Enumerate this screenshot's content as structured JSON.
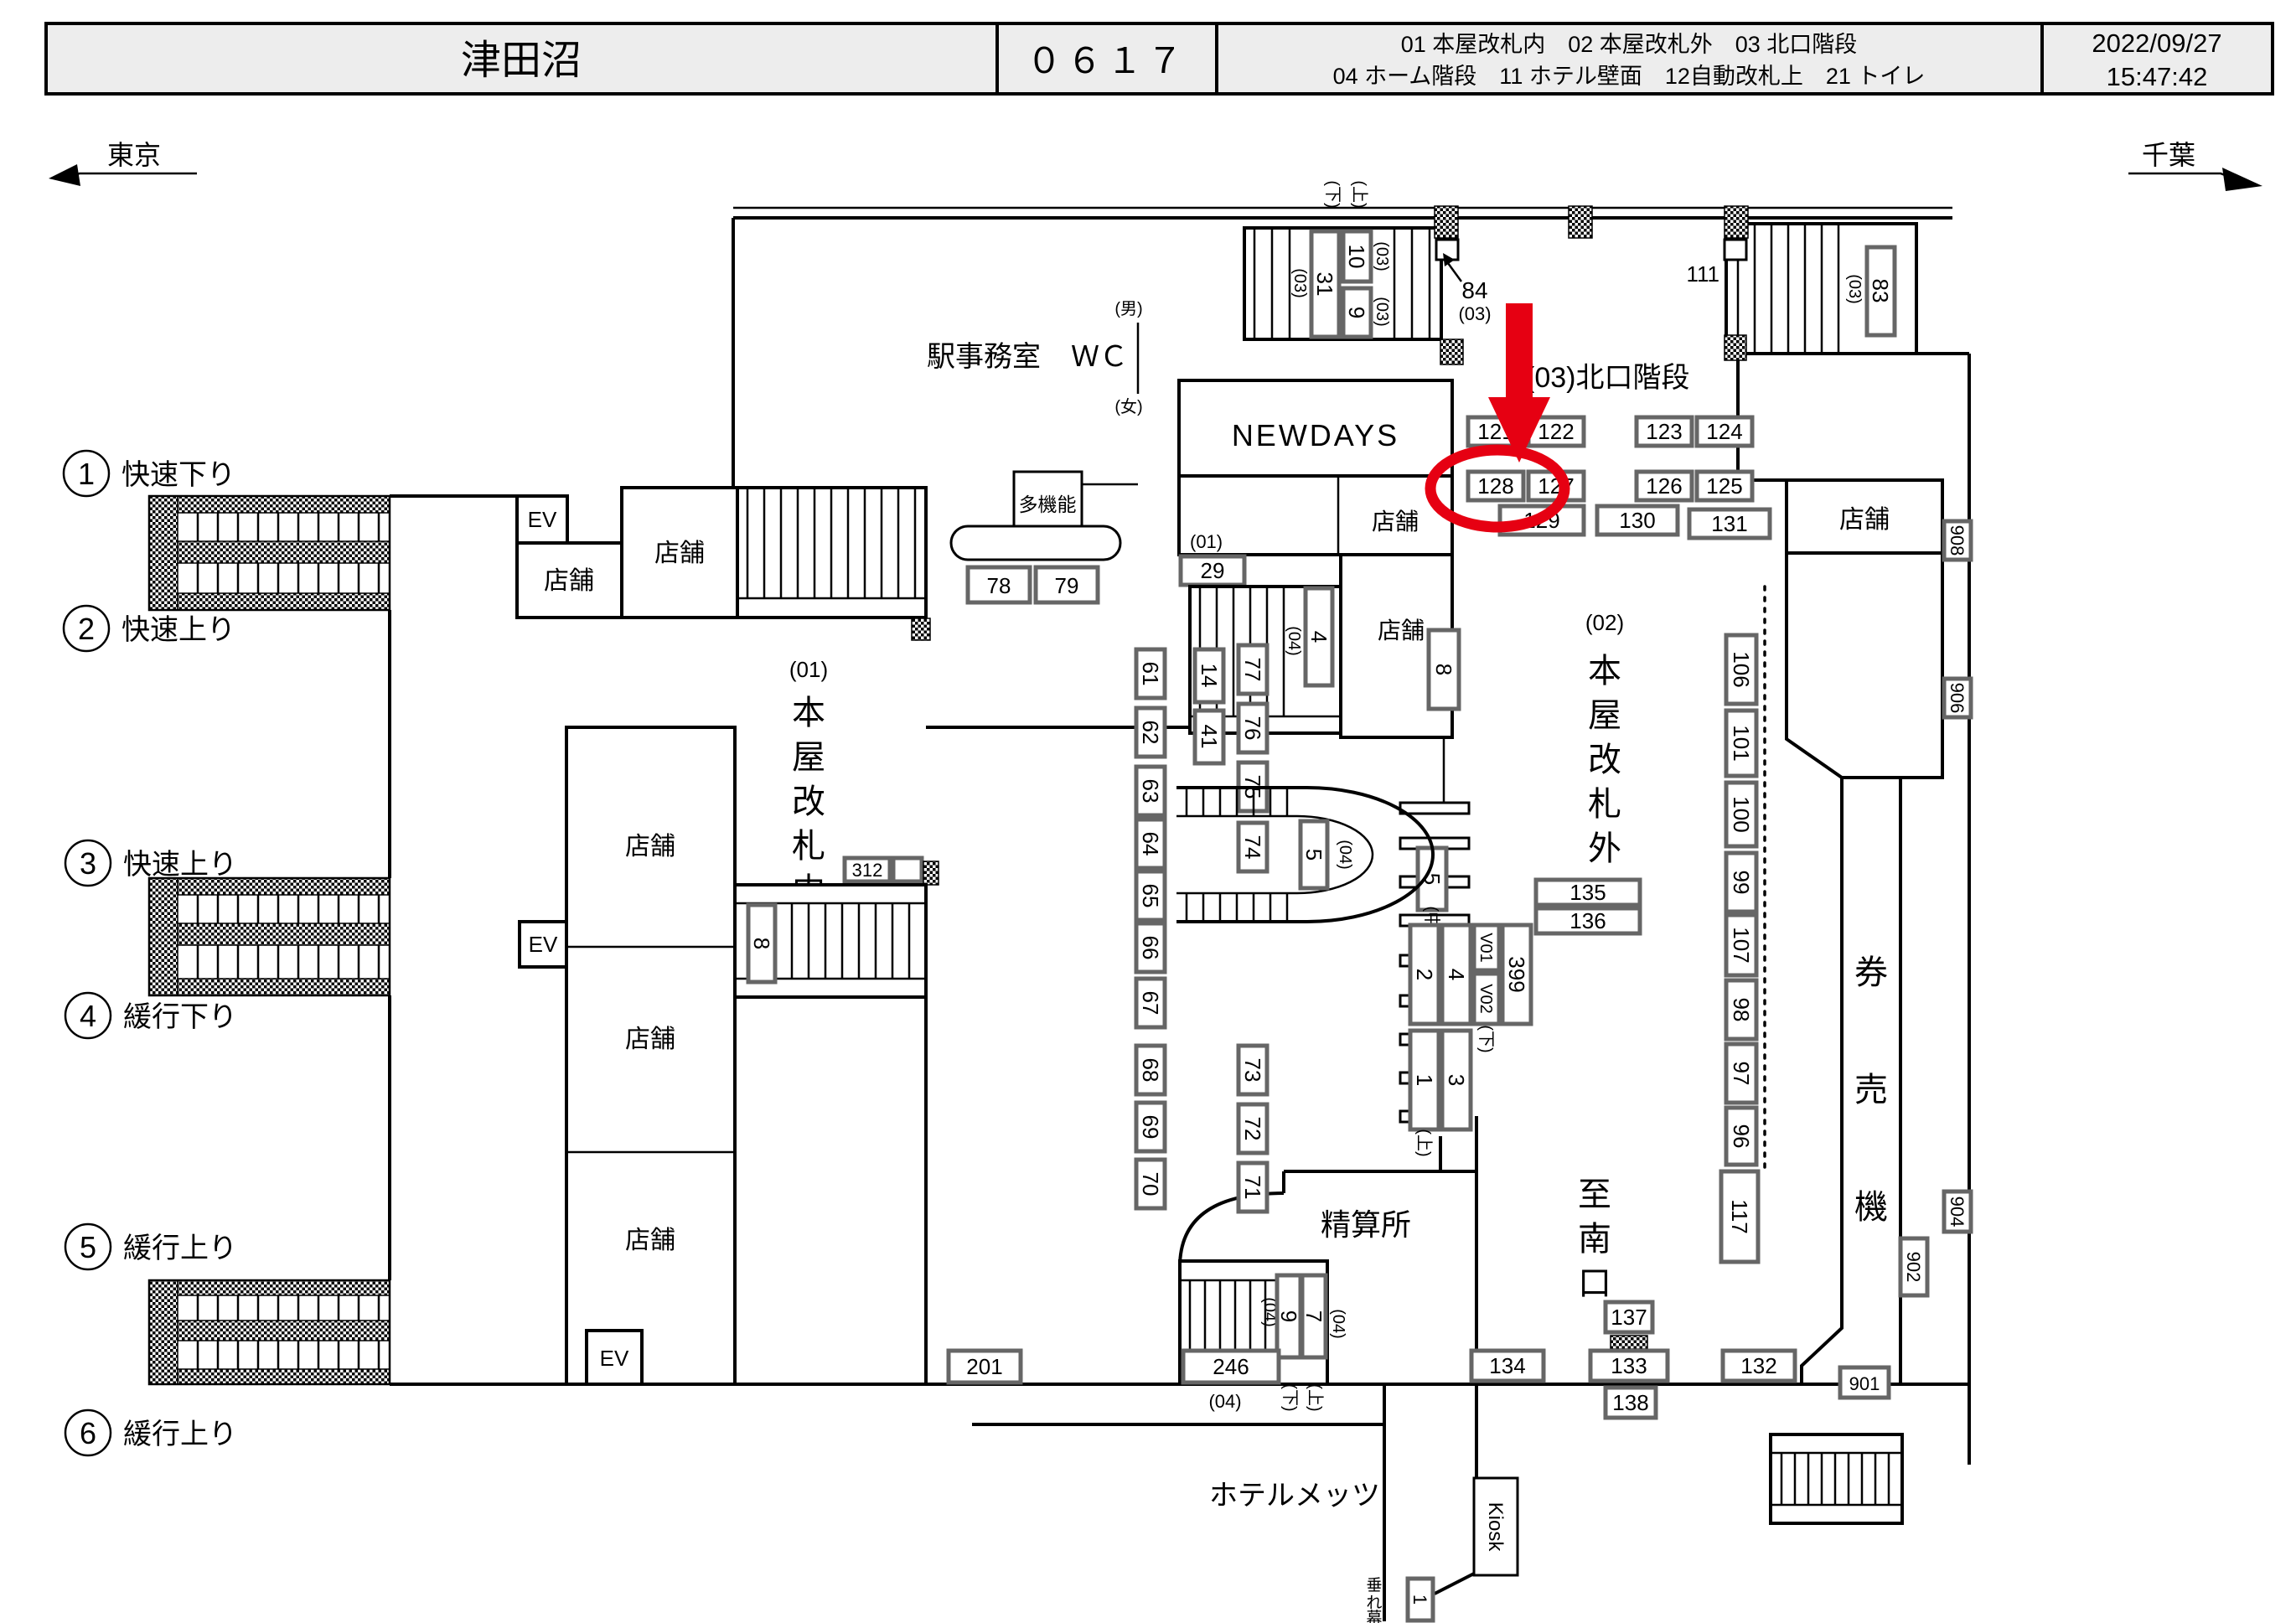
{
  "header": {
    "station": "津田沼",
    "code": "０６１７",
    "legend1": "01 本屋改札内　02 本屋改札外　03 北口階段",
    "legend2": "04 ホーム階段　11 ホテル壁面　12自動改札上　21 トイレ",
    "date": "2022/09/27",
    "time": "15:47:42"
  },
  "nav": {
    "left": "東京",
    "right": "千葉"
  },
  "platforms": [
    {
      "no": "1",
      "name": "快速下り"
    },
    {
      "no": "2",
      "name": "快速上り"
    },
    {
      "no": "3",
      "name": "快速上り"
    },
    {
      "no": "4",
      "name": "緩行下り"
    },
    {
      "no": "5",
      "name": "緩行上り"
    },
    {
      "no": "6",
      "name": "緩行上り"
    }
  ],
  "labels": {
    "office": "駅事務室",
    "wc": "ＷＣ",
    "male": "(男)",
    "female": "(女)",
    "multi": "多機能",
    "newdays": "NEWDAYS",
    "shop": "店舗",
    "ev": "EV",
    "fare": "精算所",
    "kiosk": "Kiosk",
    "hotel": "ホテルメッツ",
    "north": "(03)北口階段",
    "u01": "(01)",
    "u02": "(02)",
    "u03": "(03)",
    "u04": "(04)",
    "up": "(上)",
    "down": "(下)",
    "mid": "(中)"
  },
  "v": {
    "inside": [
      "本",
      "屋",
      "改",
      "札",
      "内"
    ],
    "outside": [
      "本",
      "屋",
      "改",
      "札",
      "外"
    ],
    "south": [
      "至",
      "南",
      "口"
    ],
    "tvm": [
      "券",
      "売",
      "機"
    ],
    "banner": [
      "垂",
      "れ",
      "幕"
    ]
  },
  "loc": {
    "1": "1",
    "2": "2",
    "3": "3",
    "4": "4",
    "5": "5",
    "7": "7",
    "8": "8",
    "9": "9",
    "10": "10",
    "14": "14",
    "29": "29",
    "31": "31",
    "41": "41",
    "61": "61",
    "62": "62",
    "63": "63",
    "64": "64",
    "65": "65",
    "66": "66",
    "67": "67",
    "68": "68",
    "69": "69",
    "70": "70",
    "71": "71",
    "72": "72",
    "73": "73",
    "74": "74",
    "75": "75",
    "76": "76",
    "77": "77",
    "78": "78",
    "79": "79",
    "83": "83",
    "84": "84",
    "96": "96",
    "97": "97",
    "98": "98",
    "99": "99",
    "100": "100",
    "101": "101",
    "106": "106",
    "107": "107",
    "111": "111",
    "117": "117",
    "121": "121",
    "122": "122",
    "123": "123",
    "124": "124",
    "125": "125",
    "126": "126",
    "127": "127",
    "128": "128",
    "129": "129",
    "130": "130",
    "131": "131",
    "132": "132",
    "133": "133",
    "134": "134",
    "135": "135",
    "136": "136",
    "137": "137",
    "138": "138",
    "201": "201",
    "246": "246",
    "312": "312",
    "399": "399",
    "901": "901",
    "902": "902",
    "904": "904",
    "906": "906",
    "908": "908",
    "V01": "V01",
    "V02": "V02"
  }
}
